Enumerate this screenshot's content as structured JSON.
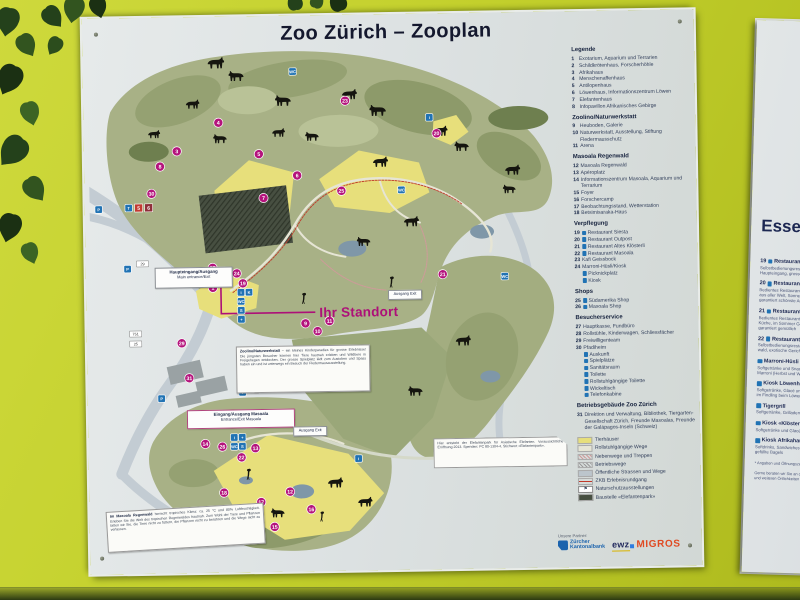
{
  "sign": {
    "title": "Zoo Zürich – Zooplan",
    "legend": {
      "sections": [
        {
          "heading": "Legende",
          "items": [
            {
              "num": "1",
              "label": "Exotarium, Aquarium und Terrarien"
            },
            {
              "num": "2",
              "label": "Schildkrötenhaus, Forscherhöhle"
            },
            {
              "num": "3",
              "label": "Afrikahaus"
            },
            {
              "num": "4",
              "label": "Menschenaffenhaus"
            },
            {
              "num": "5",
              "label": "Antilopenhaus"
            },
            {
              "num": "6",
              "label": "Löwenhaus, Informationszentrum Löwen"
            },
            {
              "num": "7",
              "label": "Elefantenhaus"
            },
            {
              "num": "8",
              "label": "Infopavillon Afrikanisches Gebirge"
            }
          ]
        },
        {
          "heading": "Zoolino/Naturwerkstatt",
          "items": [
            {
              "num": "9",
              "label": "Heuboden, Galerie"
            },
            {
              "num": "10",
              "label": "Naturwerkstatt, Ausstellung, Stiftung Fledermausschutz"
            },
            {
              "num": "11",
              "label": "Arena"
            }
          ]
        },
        {
          "heading": "Masoala Regenwald",
          "items": [
            {
              "num": "12",
              "label": "Masoala Regenwald"
            },
            {
              "num": "13",
              "label": "Apéroplatz"
            },
            {
              "num": "14",
              "label": "Informationszentrum Masoala, Aquarium und Terrarium"
            },
            {
              "num": "15",
              "label": "Foyer"
            },
            {
              "num": "16",
              "label": "Forschercamp"
            },
            {
              "num": "17",
              "label": "Beobachtungsstand, Wetterstation"
            },
            {
              "num": "18",
              "label": "Betsimisaraka-Haus"
            }
          ]
        },
        {
          "heading": "Verpflegung",
          "items": [
            {
              "num": "19",
              "icon": true,
              "label": "Restaurant Siesta"
            },
            {
              "num": "20",
              "icon": true,
              "label": "Restaurant Outpost"
            },
            {
              "num": "21",
              "icon": true,
              "label": "Restaurant Altes Klösterli"
            },
            {
              "num": "22",
              "icon": true,
              "label": "Restaurant Masoala"
            },
            {
              "num": "23",
              "label": "Kafi Geissbock"
            },
            {
              "num": "24",
              "label": "Marroni-Hüsli/Kiosk"
            },
            {
              "num": "",
              "icon": true,
              "label": "Picknickplatz"
            },
            {
              "num": "",
              "icon": true,
              "label": "Kiosk"
            }
          ]
        },
        {
          "heading": "Shops",
          "items": [
            {
              "num": "25",
              "icon": true,
              "label": "Südamerika Shop"
            },
            {
              "num": "26",
              "icon": true,
              "label": "Masoala Shop"
            }
          ]
        },
        {
          "heading": "Besucherservice",
          "items": [
            {
              "num": "27",
              "label": "Hauptkasse, Fundbüro"
            },
            {
              "num": "28",
              "label": "Rollstühle, Kinderwagen, Schliessfächer"
            },
            {
              "num": "29",
              "label": "Freiwilligenteam"
            },
            {
              "num": "30",
              "label": "Pfadiheim"
            },
            {
              "num": "",
              "icon": true,
              "label": "Auskunft"
            },
            {
              "num": "",
              "icon": true,
              "label": "Spielplätze"
            },
            {
              "num": "",
              "icon": true,
              "label": "Sanitätsraum"
            },
            {
              "num": "",
              "icon": true,
              "label": "Toilette"
            },
            {
              "num": "",
              "icon": true,
              "label": "Rollstuhlgängige Toilette"
            },
            {
              "num": "",
              "icon": true,
              "label": "Wickeltisch"
            },
            {
              "num": "",
              "icon": true,
              "label": "Telefonkabine"
            }
          ]
        },
        {
          "heading": "Betriebsgebäude Zoo Zürich",
          "items": [
            {
              "num": "31",
              "label": "Direktion und Verwaltung, Bibliothek, Tiergarten-Gesellschaft Zürich, Freunde Masoalas, Freunde der Galápagos-Inseln (Schweiz)"
            }
          ]
        }
      ],
      "swatches": [
        {
          "type": "fill",
          "color": "#e7df7b",
          "label": "Tierhäuser"
        },
        {
          "type": "fill",
          "color": "#e6e5d5",
          "label": "Rollstuhlgängige Wege"
        },
        {
          "type": "hatch",
          "color": "#cf9a9a",
          "label": "Nebenwege und Treppen"
        },
        {
          "type": "hatch",
          "color": "#9a9a9a",
          "label": "Betriebswege"
        },
        {
          "type": "fill",
          "color": "#bcc5cc",
          "label": "Öffentliche Strassen und Wege"
        },
        {
          "type": "line",
          "color": "#c0392b",
          "label": "ZKB Erlebnisrundgang"
        },
        {
          "type": "icon",
          "color": "#222222",
          "label": "Naturschutzausstellungen"
        },
        {
          "type": "fill",
          "color": "#474f41",
          "label": "Baustelle «Elefantenpark»"
        }
      ]
    },
    "partners": {
      "caption": "Unsere Partner:",
      "zkb_line1": "Zürcher",
      "zkb_line2": "Kantonalbank",
      "ewz": "ewz",
      "migros": "MIGROS"
    }
  },
  "map": {
    "your_location": "Ihr Standort",
    "boxes": {
      "main_entrance": {
        "line1": "Haupteingang/Ausgang",
        "line2": "Main entrance/Exit"
      },
      "masoala_entrance": {
        "line1": "Eingang/Ausgang Masoala",
        "line2": "Entrance/Exit Masoala"
      },
      "exit1": "Ausgang Exit",
      "exit2": "Ausgang Exit",
      "zoolino_note_title": "Zoolino/Naturwerkstatt",
      "zoolino_note_body": "– ein kleines Kinderparadies für grosse Erlebnisse! Die jüngsten Besucher können hier Tiere hautnah erleben und Wildtiere in Freigehegen entdecken. Der grosse Spielplatz lädt zum Austoben und Spass haben ein und ist unterwegs ein Besuch der Fledermausausstellung.",
      "masoala_note_title": "Im Masoala Regenwald",
      "masoala_note_body": "herrscht tropisches Klima: ca. 25 °C und 80% Luftfeuchtigkeit. Erleben Sie die Welt des tropischen Regenwaldes hautnah. Zum Wohl der Tiere und Pflanzen bitten wir Sie, die Tiere nicht zu füttern, die Pflanzen nicht zu berühren und die Wege nicht zu verlassen.",
      "elefant_note": "Hier entsteht der Elefantenpark für Asiatische Elefanten. Voraussichtliche Eröffnung 2013. Spenden: PC 80-1304-4, Stichwort «Elefantenpark»."
    },
    "markers": [
      {
        "n": "1",
        "x": 122,
        "y": 247
      },
      {
        "n": "2",
        "x": 107,
        "y": 232
      },
      {
        "n": "3",
        "x": 88,
        "y": 110
      },
      {
        "n": "4",
        "x": 130,
        "y": 82
      },
      {
        "n": "5",
        "x": 170,
        "y": 114
      },
      {
        "n": "6",
        "x": 208,
        "y": 136
      },
      {
        "n": "7",
        "x": 174,
        "y": 158
      },
      {
        "n": "8",
        "x": 71,
        "y": 125
      },
      {
        "n": "9",
        "x": 214,
        "y": 284
      },
      {
        "n": "10",
        "x": 226,
        "y": 292
      },
      {
        "n": "11",
        "x": 238,
        "y": 282
      },
      {
        "n": "12",
        "x": 196,
        "y": 452
      },
      {
        "n": "13",
        "x": 162,
        "y": 408
      },
      {
        "n": "14",
        "x": 112,
        "y": 403
      },
      {
        "n": "15",
        "x": 180,
        "y": 487
      },
      {
        "n": "16",
        "x": 217,
        "y": 470
      },
      {
        "n": "17",
        "x": 167,
        "y": 462
      },
      {
        "n": "18",
        "x": 130,
        "y": 452
      },
      {
        "n": "19",
        "x": 152,
        "y": 243
      },
      {
        "n": "20",
        "x": 348,
        "y": 96
      },
      {
        "n": "21",
        "x": 352,
        "y": 237
      },
      {
        "n": "22",
        "x": 148,
        "y": 417
      },
      {
        "n": "23",
        "x": 257,
        "y": 62
      },
      {
        "n": "24",
        "x": 146,
        "y": 233
      },
      {
        "n": "25",
        "x": 252,
        "y": 152
      },
      {
        "n": "26",
        "x": 129,
        "y": 406
      },
      {
        "n": "27",
        "x": 122,
        "y": 227
      },
      {
        "n": "28",
        "x": 134,
        "y": 231
      },
      {
        "n": "29",
        "x": 90,
        "y": 302
      },
      {
        "n": "30",
        "x": 62,
        "y": 152
      },
      {
        "n": "31",
        "x": 97,
        "y": 337
      }
    ],
    "blue_icons": [
      {
        "x": 9,
        "y": 167,
        "g": "P"
      },
      {
        "x": 37,
        "y": 227,
        "g": "P"
      },
      {
        "x": 69,
        "y": 357,
        "g": "P"
      },
      {
        "x": 39,
        "y": 166,
        "g": "T"
      },
      {
        "x": 150,
        "y": 252,
        "g": "i"
      },
      {
        "x": 150,
        "y": 261,
        "g": "WC"
      },
      {
        "x": 150,
        "y": 270,
        "g": "S"
      },
      {
        "x": 150,
        "y": 279,
        "g": "+"
      },
      {
        "x": 158,
        "y": 252,
        "g": "K"
      },
      {
        "x": 141,
        "y": 397,
        "g": "i"
      },
      {
        "x": 141,
        "y": 406,
        "g": "WC"
      },
      {
        "x": 149,
        "y": 397,
        "g": "+"
      },
      {
        "x": 149,
        "y": 406,
        "g": "S"
      },
      {
        "x": 205,
        "y": 32,
        "g": "WC"
      },
      {
        "x": 312,
        "y": 152,
        "g": "WC"
      },
      {
        "x": 150,
        "y": 352,
        "g": "i"
      },
      {
        "x": 265,
        "y": 420,
        "g": "i"
      },
      {
        "x": 341,
        "y": 80,
        "g": "i"
      },
      {
        "x": 414,
        "y": 240,
        "g": "WC"
      }
    ],
    "tram_stops": [
      {
        "x": 49,
        "y": 166,
        "label": "5",
        "color": "#c23a32"
      },
      {
        "x": 59,
        "y": 166,
        "label": "6",
        "color": "#8f2f3a"
      }
    ],
    "white_tags": [
      {
        "x": 52,
        "y": 222,
        "label": "29"
      },
      {
        "x": 44,
        "y": 292,
        "label": "751"
      },
      {
        "x": 44,
        "y": 302,
        "label": "25"
      },
      {
        "x": 160,
        "y": 350,
        "label": "19"
      }
    ],
    "animals": [
      [
        118,
        16,
        1.1,
        1,
        "q"
      ],
      [
        158,
        30,
        1.0,
        -1,
        "q"
      ],
      [
        96,
        58,
        0.9,
        1,
        "q"
      ],
      [
        205,
        55,
        1.05,
        -1,
        "q"
      ],
      [
        252,
        50,
        1.0,
        1,
        "q"
      ],
      [
        300,
        66,
        1.1,
        -1,
        "q"
      ],
      [
        342,
        88,
        1.0,
        1,
        "q"
      ],
      [
        382,
        104,
        0.95,
        -1,
        "q"
      ],
      [
        414,
        128,
        1.0,
        1,
        "q"
      ],
      [
        232,
        92,
        0.9,
        -1,
        "q"
      ],
      [
        282,
        118,
        1.0,
        1,
        "q"
      ],
      [
        182,
        88,
        0.85,
        1,
        "q"
      ],
      [
        140,
        93,
        0.9,
        -1,
        "q"
      ],
      [
        312,
        178,
        1.0,
        1,
        "q"
      ],
      [
        282,
        198,
        0.9,
        -1,
        "q"
      ],
      [
        362,
        298,
        1.0,
        1,
        "q"
      ],
      [
        332,
        348,
        0.95,
        -1,
        "q"
      ],
      [
        232,
        438,
        1.0,
        1,
        "q"
      ],
      [
        192,
        468,
        0.9,
        -1,
        "q"
      ],
      [
        262,
        458,
        0.95,
        1,
        "q"
      ],
      [
        58,
        88,
        0.8,
        1,
        "q"
      ],
      [
        428,
        148,
        0.85,
        -1,
        "q"
      ],
      [
        210,
        253,
        1,
        1,
        "b"
      ],
      [
        298,
        238,
        1,
        1,
        "b"
      ],
      [
        152,
        428,
        1,
        1,
        "b"
      ],
      [
        225,
        472,
        0.9,
        1,
        "b"
      ]
    ]
  },
  "side_sign": {
    "heading": "Essen und Trinken",
    "items": [
      {
        "num": "19",
        "name": "Restaurant Siesta",
        "desc": "Selbstbedienungsrestaurant beim\nHaupteingang, grosse Terrasse"
      },
      {
        "num": "20",
        "name": "Restaurant Outpost",
        "desc": "Bedientes Restaurant mit Spezialitäten\naus aller Welt, Sonnenterrasse,\ngarantiert schönste Aussicht"
      },
      {
        "num": "21",
        "name": "Restaurant Altes Klösterli",
        "desc": "Bedientes Restaurant mit bürgerlicher\nKüche, im Sommer Gartenwirtschaft,\ngarantiert gemütlich"
      },
      {
        "num": "22",
        "name": "Restaurant Masoala",
        "desc": "Selbstbedienungsrestaurant am Regen-\nwald, exotische Gerichte"
      },
      {
        "num": "",
        "name": "Marroni-Hüsli",
        "desc": "Softgetränke und Snacks,\nMarroni (Herbst und Winter)"
      },
      {
        "num": "",
        "name": "Kiosk Löwenhaus",
        "desc": "Softgetränke, Glacé und Snacks\nim Findling beim Löwenhaus"
      },
      {
        "num": "",
        "name": "Tigergrill",
        "desc": "Softgetränke, Grilladen und Snacks"
      },
      {
        "num": "",
        "name": "Kiosk «Klösterli»",
        "desc": "Softgetränke und Glacé"
      },
      {
        "num": "",
        "name": "Kiosk Afrikahaus",
        "desc": "Softdrinks, Sandwiches und\ngefüllte Bagels"
      }
    ],
    "footnotes": "* Angaben und Öffnungszeiten siehe Aushang\n\nGerne beraten wir Sie an der Hauptkasse\nund weiteren Örtlichkeiten im Zoo."
  }
}
